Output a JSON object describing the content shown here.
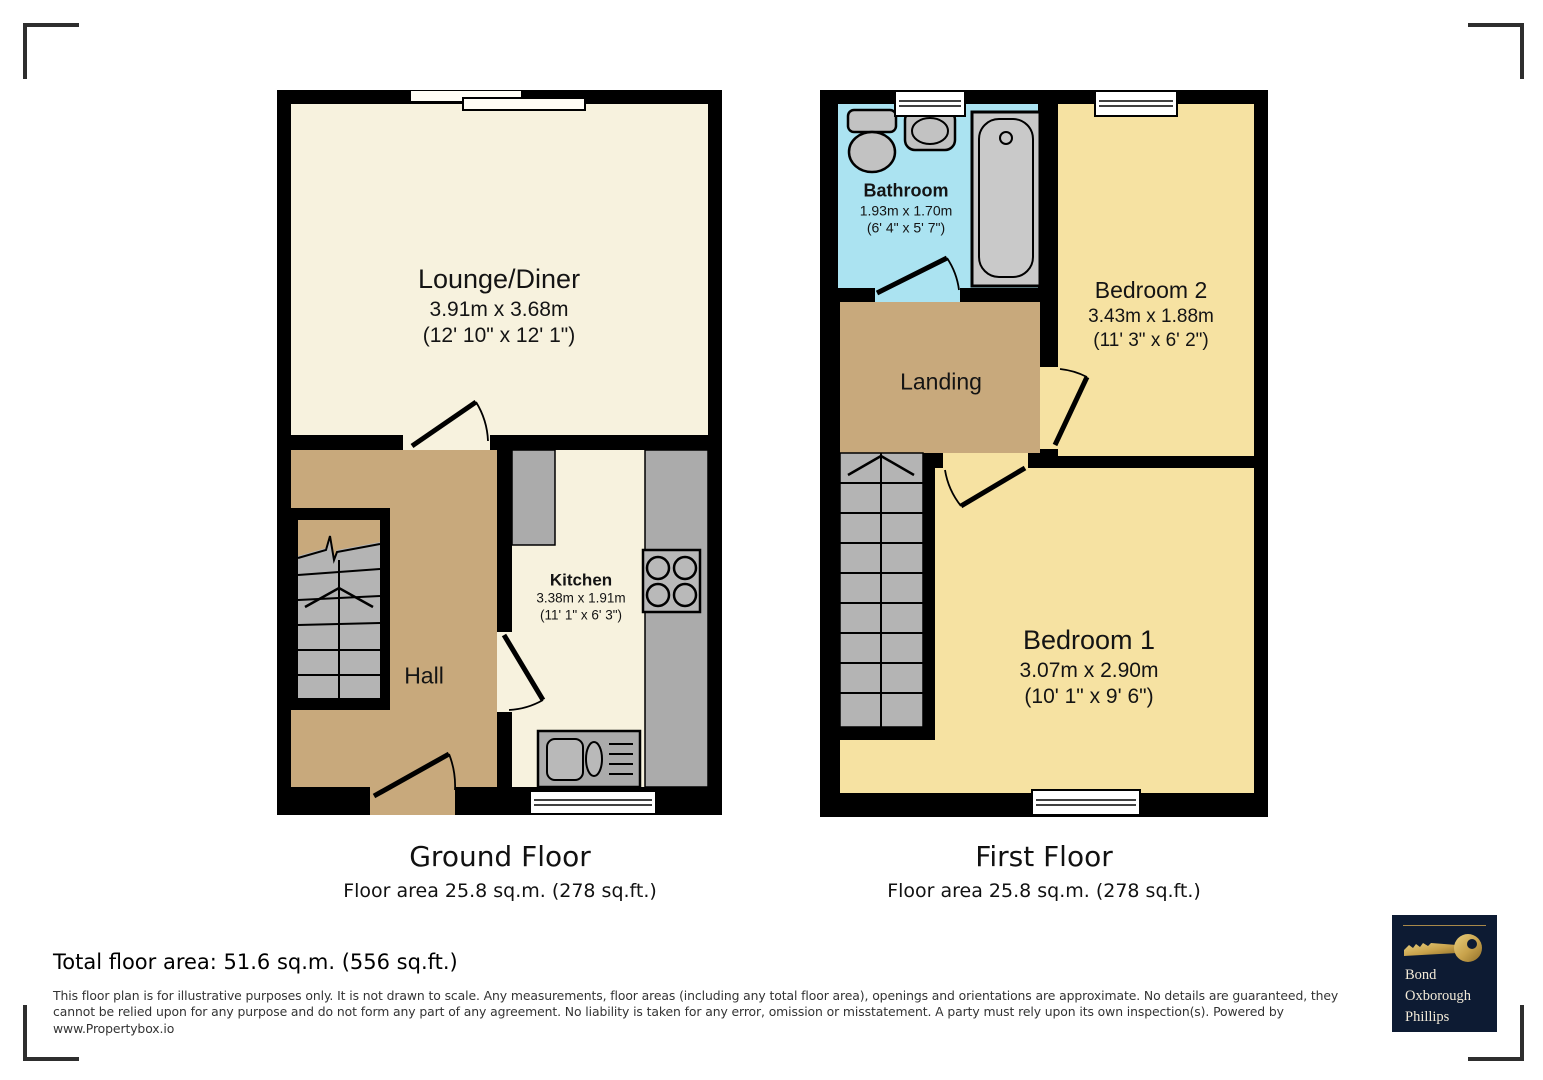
{
  "colors": {
    "wall": "#000000",
    "cream": "#f7f2de",
    "tan": "#c8a97c",
    "yellow": "#f6e2a2",
    "blue": "#abe3f1",
    "counter_gray": "#ababab",
    "stair_gray": "#b4b4b4",
    "logo_navy": "#0d1b33",
    "logo_gold": "#c8a24b"
  },
  "floors": [
    {
      "title": "Ground Floor",
      "area_line": "Floor area 25.8 sq.m. (278 sq.ft.)",
      "rooms": [
        {
          "name": "Lounge/Diner",
          "metric": "3.91m x 3.68m",
          "imperial": "(12' 10\" x 12' 1\")"
        },
        {
          "name": "Kitchen",
          "metric": "3.38m x 1.91m",
          "imperial": "(11' 1\" x 6' 3\")"
        },
        {
          "name": "Hall"
        }
      ],
      "features": [
        "stairs",
        "entrance-door",
        "sliding-window",
        "kitchen-window",
        "hob",
        "sink",
        "counters"
      ]
    },
    {
      "title": "First Floor",
      "area_line": "Floor area 25.8 sq.m. (278 sq.ft.)",
      "rooms": [
        {
          "name": "Bathroom",
          "metric": "1.93m x 1.70m",
          "imperial": "(6' 4\" x 5' 7\")"
        },
        {
          "name": "Landing"
        },
        {
          "name": "Bedroom 2",
          "metric": "3.43m x 1.88m",
          "imperial": "(11' 3\" x 6' 2\")"
        },
        {
          "name": "Bedroom 1",
          "metric": "3.07m x 2.90m",
          "imperial": "(10' 1\" x 9' 6\")"
        }
      ],
      "features": [
        "stairs",
        "bath",
        "toilet",
        "basin",
        "windows"
      ]
    }
  ],
  "summary": {
    "total_area": "Total floor area: 51.6 sq.m. (556 sq.ft.)"
  },
  "disclaimer": "This floor plan is for illustrative purposes only. It is not drawn to scale. Any measurements, floor areas (including any total floor area), openings and orientations are approximate. No details are guaranteed, they cannot be relied upon for any purpose and do not form any part of any agreement. No liability is taken for any error, omission or misstatement. A party must rely upon its own inspection(s). Powered by www.Propertybox.io",
  "logo": {
    "lines": [
      "Bond",
      "Oxborough",
      "Phillips"
    ]
  }
}
